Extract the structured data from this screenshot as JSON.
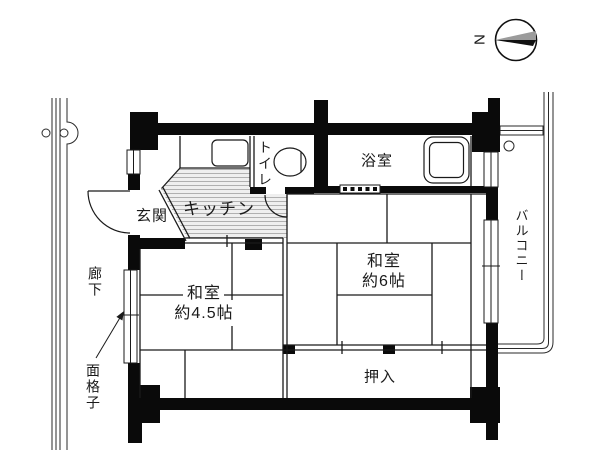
{
  "compass": {
    "north": "N"
  },
  "rooms": {
    "genkan": {
      "label": "玄関"
    },
    "kitchen": {
      "label": "キッチン"
    },
    "toilet": {
      "label": "トイレ"
    },
    "bathroom": {
      "label": "浴室"
    },
    "washitsu_6": {
      "label": "和室",
      "size": "約6帖"
    },
    "washitsu_45": {
      "label": "和室",
      "size": "約4.5帖"
    },
    "oshiire": {
      "label": "押入"
    },
    "balcony": {
      "label": "バルコニー"
    },
    "corridor": {
      "label": "廊下"
    },
    "window_grate": {
      "label": "面格子"
    }
  },
  "colors": {
    "wall": "#0a0a0a",
    "line": "#1a1a1a",
    "hatch_line": "#b0b0b0",
    "hatch_bg": "#efefef",
    "compass_gray": "#9b9b9b",
    "background": "#ffffff",
    "text": "#1a1a1a"
  }
}
